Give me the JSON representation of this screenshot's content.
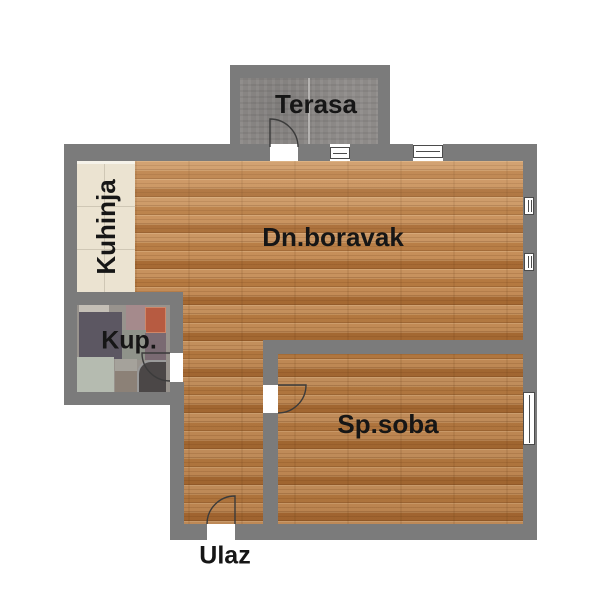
{
  "floorplan": {
    "colors": {
      "background": "#ffffff",
      "wall": "#7b7b7b",
      "wood": "#bf854e",
      "kitchen_tile": "#ebe3d1",
      "terrace_tile": "#8d8a88",
      "text": "#161616"
    },
    "rooms": {
      "terrace": {
        "label": "Terasa"
      },
      "kitchen": {
        "label": "Kuhinja"
      },
      "living_room": {
        "label": "Dn.boravak"
      },
      "bathroom": {
        "label": "Kup."
      },
      "bedroom": {
        "label": "Sp.soba"
      },
      "entrance": {
        "label": "Ulaz"
      }
    },
    "symbols": {
      "doors": [
        "terrace-door",
        "bathroom-door",
        "bedroom-door",
        "entrance-door"
      ],
      "windows": [
        "terrace-small-window",
        "top-wall-window",
        "bedroom-window"
      ],
      "radiators": [
        "radiator-1",
        "radiator-2"
      ]
    }
  }
}
